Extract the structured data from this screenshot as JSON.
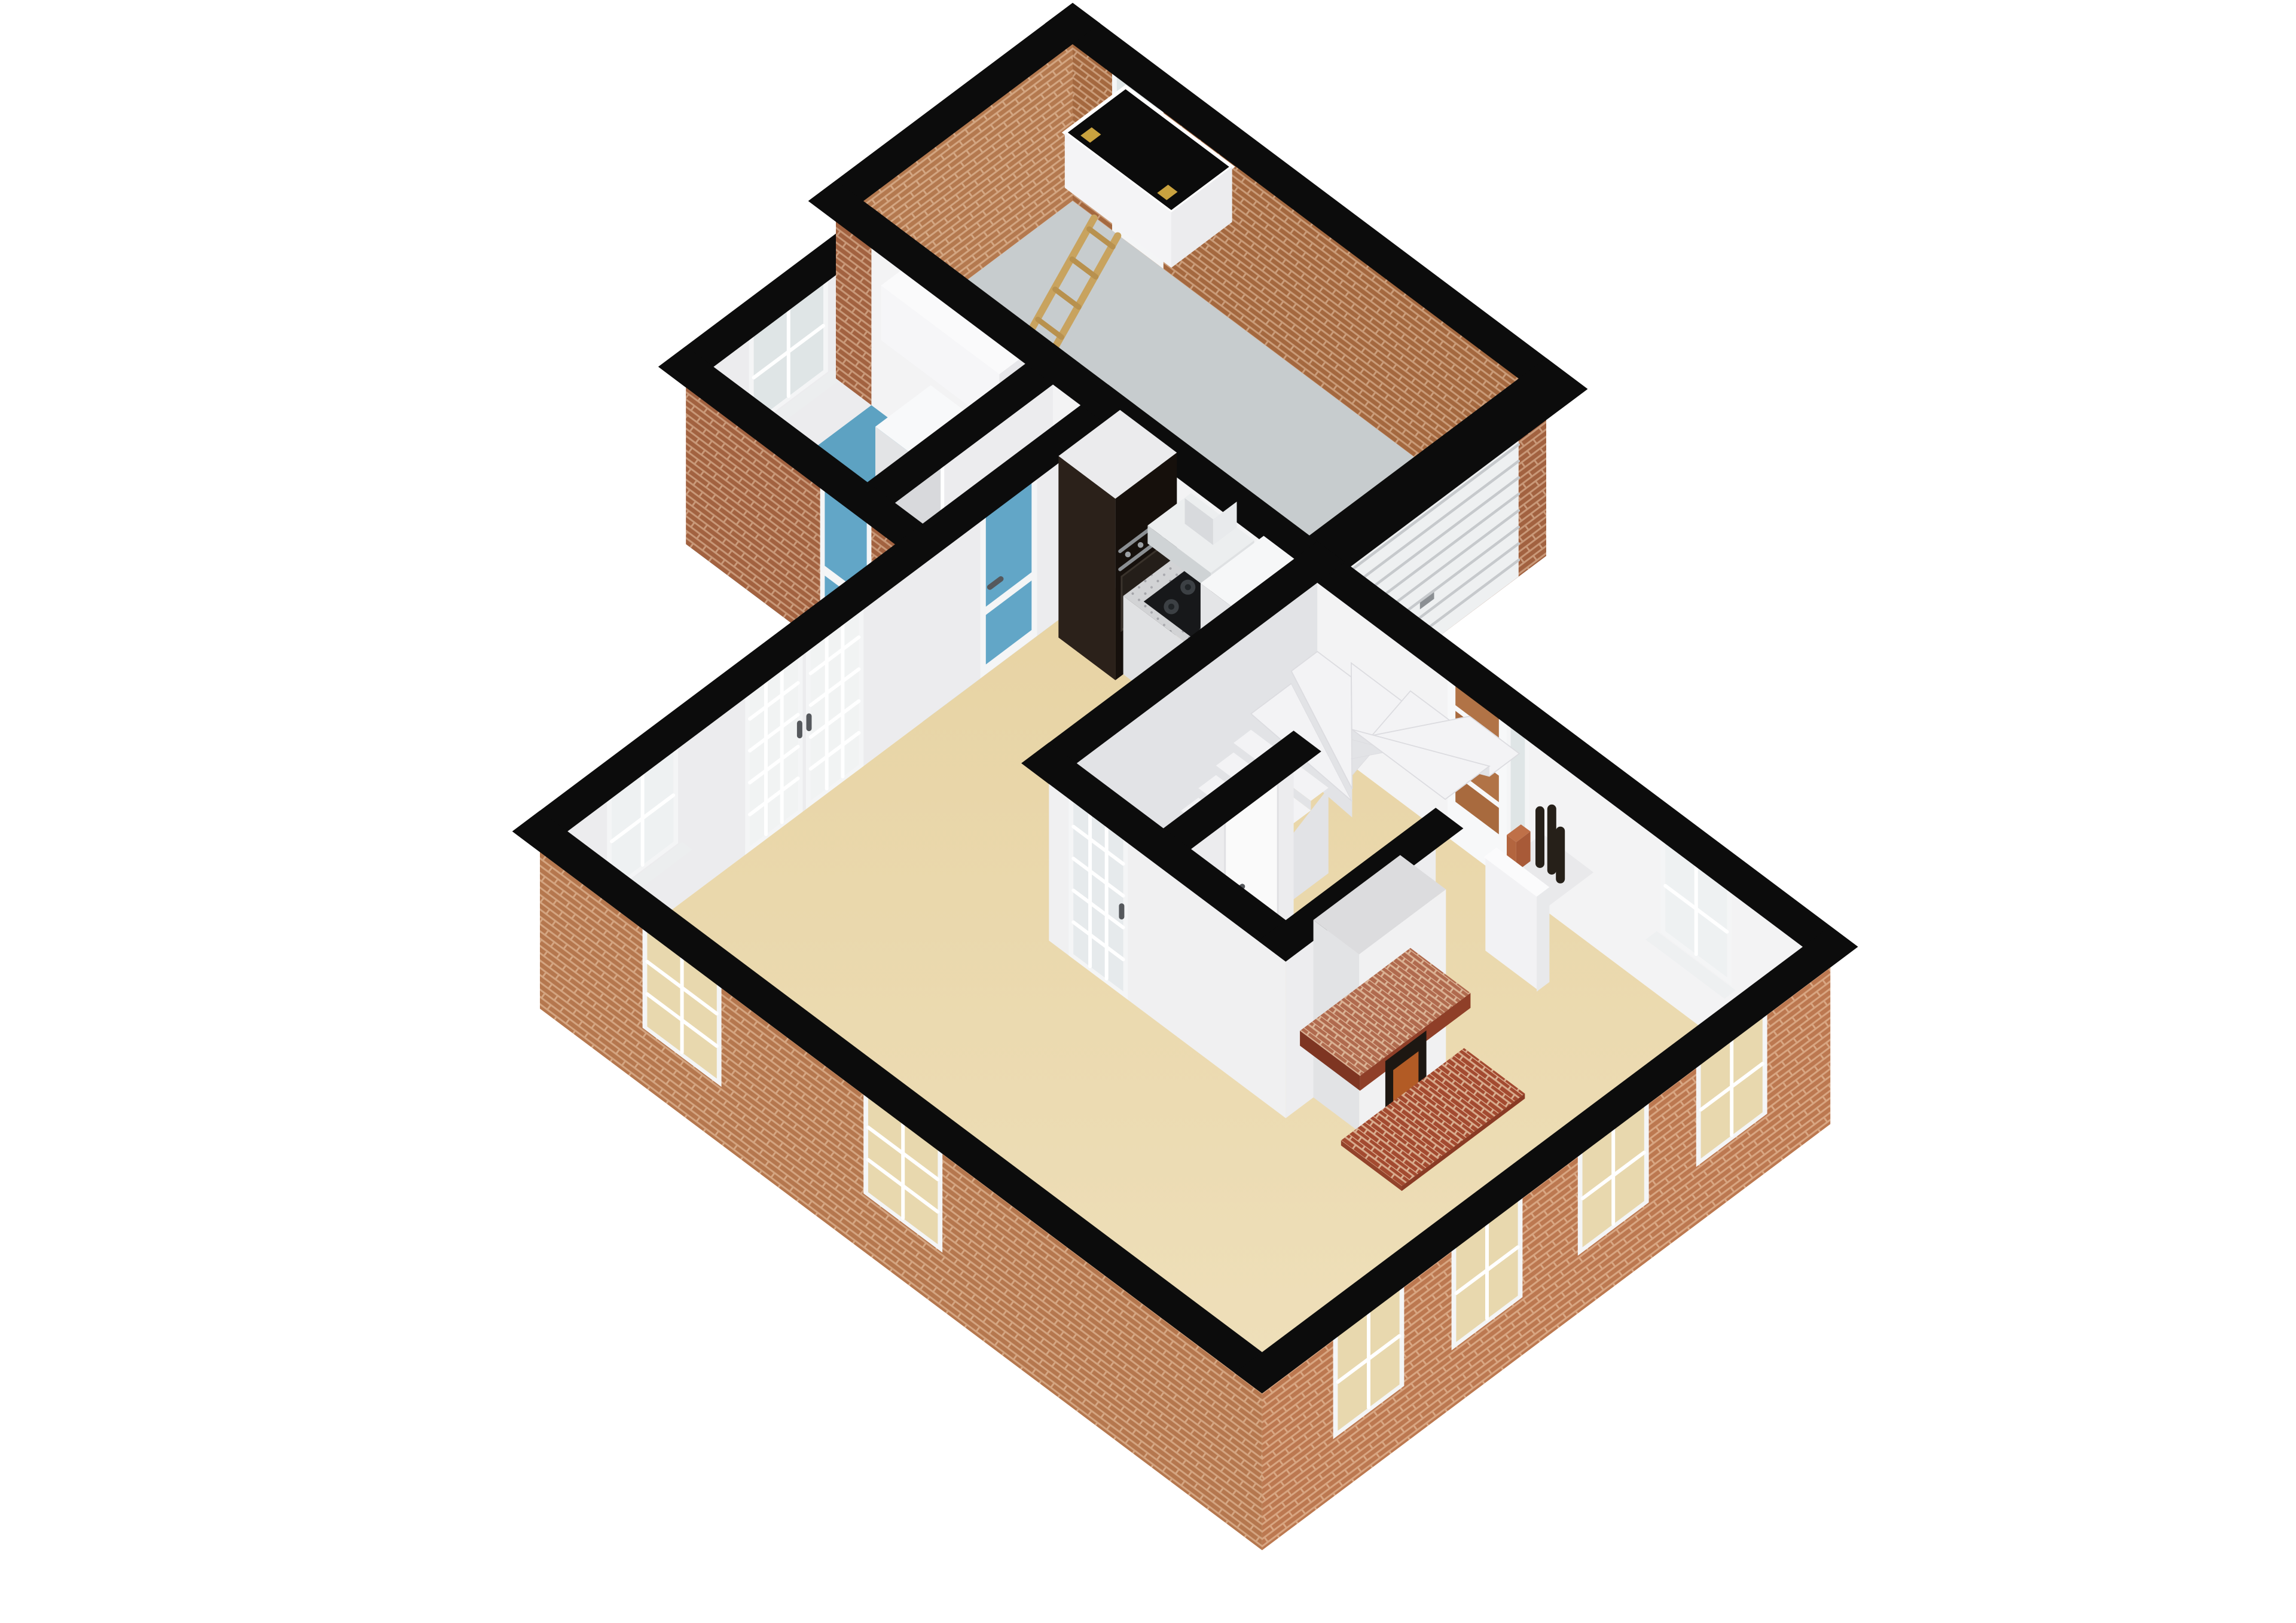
{
  "scene": {
    "type": "3d-floorplan-cutaway-render",
    "background": "#ffffff",
    "floor_level": "ground-floor",
    "rooms": [
      {
        "name": "garage",
        "floor": "gray",
        "features": [
          "glazed-back-door",
          "attic-hatch-with-wooden-ladder",
          "roller-garage-door",
          "brick-interior-walls"
        ]
      },
      {
        "name": "utility-room",
        "floor": "blue",
        "features": [
          "four-pane-window",
          "wall-cabinet",
          "washing-machine",
          "tumble-dryer",
          "doorway-to-lobby"
        ]
      },
      {
        "name": "rear-lobby",
        "floor": "blue",
        "features": [
          "blue-glazed-exterior-door",
          "blue-glazed-interior-door"
        ]
      },
      {
        "name": "kitchen",
        "floor": "beige",
        "features": [
          "tall-black-oven-unit",
          "countertop-with-gas-hob",
          "extractor-hood",
          "tall-white-unit"
        ]
      },
      {
        "name": "hallway",
        "floor": "beige",
        "features": [
          "winder-staircase",
          "under-stair-closet-door",
          "front-door-with-sidelight",
          "bottle-niche"
        ]
      },
      {
        "name": "living-dining-room",
        "floor": "beige",
        "features": [
          "french-doors",
          "fireplace-with-brick-hearth",
          "sash-windows"
        ]
      }
    ],
    "window_counts": {
      "sw-facade": 2,
      "se-facade": 4,
      "nw-facade": 2,
      "interior-visible": 3
    }
  },
  "colors": {
    "background": "#ffffff",
    "cutBand": "#0c0c0c",
    "brickExtA": "#a26240",
    "brickExtB": "#b5774e",
    "brickExtC": "#bc7850",
    "brickIntNE": "#a4683f",
    "brickIntNW": "#b4794f",
    "brickPier": "#b57a52",
    "mortar": "rgba(255,228,200,0.42)",
    "floorGarage": "#c7ccce",
    "floorLaundry": "#5da2c2",
    "floorMainTop": "#e7d3a3",
    "floorMainBottom": "#f0e2bf",
    "wallBright": "#f3f3f4",
    "wallWhite": "#ececee",
    "wallDim": "#e2e3e6",
    "wallShade": "#d8d9dc",
    "frame": "#f4f5f6",
    "glass": "#eef1f2",
    "glassCool": "#dfe5e6",
    "glassBeige": "#e8d8ae",
    "glassBlue": "#62a6c7",
    "roller": "#eef0f1",
    "rollerLine": "#c6c9cc",
    "unitBlack": "#16100c",
    "unitSide": "#2b211a",
    "ovenDark": "#241e19",
    "steel": "#8b8f93",
    "counterTop": "#d2d3d5",
    "counterFace": "#eceded",
    "hob": "#17181a",
    "burner": "#3c4044",
    "hood": "#dfe1e3",
    "hoodSide": "#cfd3d5",
    "stairTop": "#f3f3f5",
    "stairRiser": "#e2e3e6",
    "wood": "#c8a35f",
    "woodDark": "#b8914e",
    "gold": "#c9a23f",
    "hearthBase": "#a34a30",
    "hearthDark": "#8a3b25",
    "hearthSide": "#93432b",
    "brickShelf": "#8f3f28",
    "brickShelfDark": "#7e3522",
    "brickShelfTop": "#b06a4e",
    "fireGlow": "#b25b25",
    "fireboxDark": "#1d1712",
    "bottle": "#262019",
    "terracotta": "#a85a38",
    "doorAmber": "#a86a3e",
    "doorAmber2": "#b17346",
    "handleDark": "#55585c"
  }
}
